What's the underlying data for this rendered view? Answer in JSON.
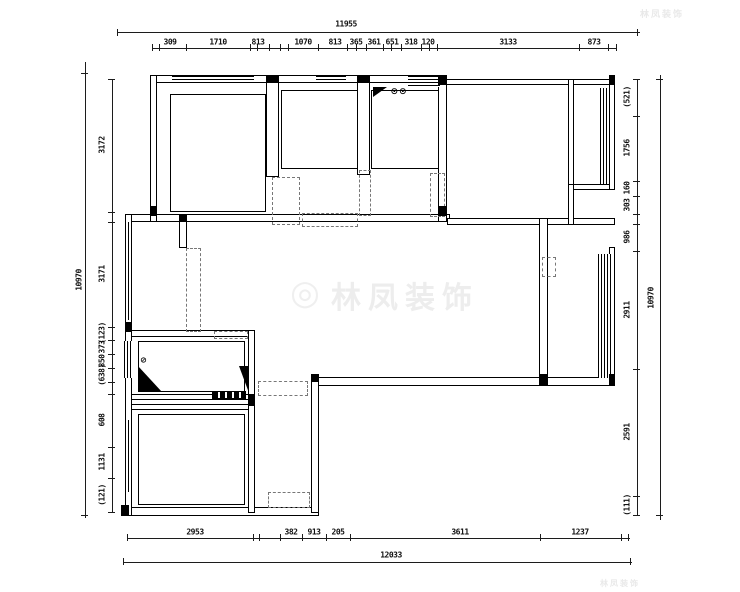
{
  "plan": {
    "totals": {
      "top": "11955",
      "bottom": "12033",
      "left": "10970",
      "right": "10970"
    },
    "top_segments": [
      "309",
      "1710",
      "813",
      "1070",
      "813",
      "365",
      "361",
      "651",
      "318",
      "120",
      "3133",
      "873"
    ],
    "bottom_segments": [
      "2953",
      "382",
      "913",
      "205",
      "3611",
      "1237"
    ],
    "left_segments": [
      "3172",
      "3171",
      "(123)",
      "373",
      "850",
      "(638)",
      "608",
      "1131",
      "(121)"
    ],
    "right_segments": [
      "(521)",
      "1756",
      "160",
      "303",
      "986",
      "2911",
      "2591",
      "(111)"
    ],
    "symbols": {
      "stove_burners": "⊙⊙",
      "floor_drain": "⊘"
    },
    "watermark": {
      "logo_glyph": "◎",
      "text": "林凤装饰",
      "corner_text_top": "林凤装饰",
      "corner_text_bottom": "林凤装饰"
    }
  }
}
